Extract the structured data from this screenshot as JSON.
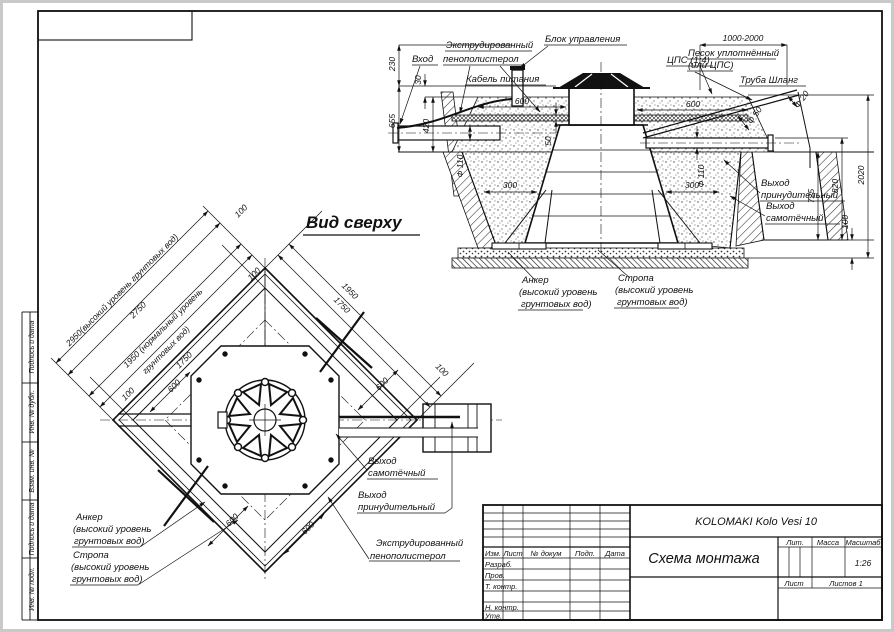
{
  "frame": {
    "side_labels": [
      "Подпись и дата",
      "Инв. № дубл.",
      "Взам. инв. №",
      "Подпись и дата",
      "Инв. № подл."
    ]
  },
  "section": {
    "labels": {
      "eps1": "Экструдированный",
      "eps2": "пенополистерол",
      "inlet": "Вход",
      "control": "Блок управления",
      "cable": "Кабель питания",
      "cps": "ЦПС (1:4)",
      "sand1": "Песок уплотнённый",
      "sand2": "(или ЦПС)",
      "hose": "Труба Шланг",
      "outf1": "Выход",
      "outf2": "принудительный",
      "outg1": "Выход",
      "outg2": "самотёчный",
      "anchor1": "Анкер",
      "anchor2": "(высокий уровень",
      "anchor3": "грунтовых вод)",
      "strap1": "Стропа",
      "strap2": "(высокий уровень",
      "strap3": "грунтовых вод)"
    },
    "dims": {
      "d230": "230",
      "d30": "30",
      "d655": "655",
      "d420": "420",
      "d600l": "600",
      "d600r": "600",
      "d50": "50",
      "dphi110l": "Ф 110",
      "dphi110r": "Ф 110",
      "dphi50": "Ф 50",
      "dphi20": "Ф 20",
      "d300l": "300",
      "d300r": "300",
      "d1000": "1000-2000",
      "d725": "725",
      "d820": "820",
      "d2020": "2020",
      "d100": "100"
    }
  },
  "top": {
    "title": "Вид сверху",
    "dims": {
      "d2950": "2950(высокий уровень грунтовых вод)",
      "d2750": "2750",
      "d1950a": "1950 (нормальный уровень",
      "d1950b": "грунтовых вод)",
      "d1750": "1750",
      "ne1950": "1950",
      "ne1750": "1750",
      "d100s": [
        "100",
        "100",
        "100",
        "100"
      ],
      "d600s": [
        "600",
        "600",
        "600",
        "600"
      ]
    },
    "labels": {
      "anchor1": "Анкер",
      "anchor2": "(высокий уровень",
      "anchor3": "грунтовых вод)",
      "strap1": "Стропа",
      "strap2": "(высокий уровень",
      "strap3": "грунтовых вод)",
      "outg1": "Выход",
      "outg2": "самотёчный",
      "outf1": "Выход",
      "outf2": "принудительный",
      "eps1": "Экструдированный",
      "eps2": "пенополистерол"
    }
  },
  "title_block": {
    "product": "KOLOMAKI Kolo Vesi 10",
    "doc_title": "Схема монтажа",
    "lit": "Лит.",
    "mass": "Масса",
    "scale_label": "Масштаб",
    "scale": "1:26",
    "sheet": "Лист",
    "sheets": "Листов 1",
    "cols": {
      "izm": "Изм.",
      "list": "Лист",
      "doc": "№ докум",
      "sign": "Подп.",
      "date": "Дата"
    },
    "roles": [
      "Разраб.",
      "Пров.",
      "Т. контр.",
      "Н. контр.",
      "Утв."
    ]
  }
}
